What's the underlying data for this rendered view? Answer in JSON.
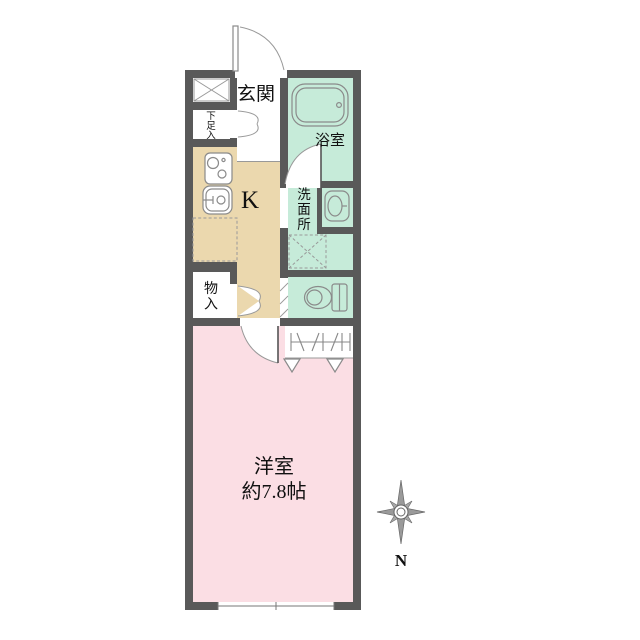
{
  "floorplan": {
    "rooms": {
      "genkan": {
        "label": "玄関"
      },
      "shoe_storage": {
        "label": "下足入"
      },
      "bathroom": {
        "label": "浴室"
      },
      "kitchen": {
        "label": "K"
      },
      "washroom": {
        "label": "洗面所"
      },
      "storage": {
        "label": "物入"
      },
      "western_room": {
        "label": "洋室",
        "size": "約7.8帖"
      }
    },
    "compass": {
      "north_label": "N"
    },
    "colors": {
      "wall": "#595959",
      "wet_area_green": "#c6ebd9",
      "kitchen_beige": "#ebd8ae",
      "room_pink": "#fbdee4",
      "floor_white": "#ffffff"
    }
  }
}
